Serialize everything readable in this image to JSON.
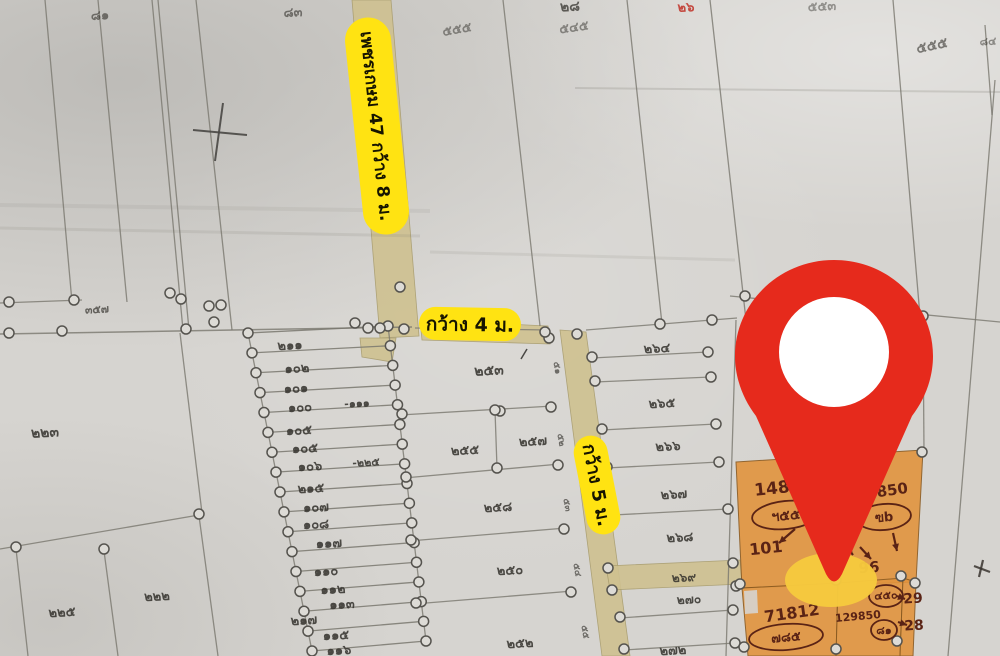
{
  "map": {
    "colors": {
      "paper": "#d6d4d0",
      "pencil": "#7a786f",
      "ink": "#33312c",
      "road_fill": "#cfc190",
      "label_bg": "#ffe312",
      "label_text": "#161400",
      "pin_red": "#e62a1c",
      "pin_shadow": "#f6c93e",
      "plot_orange": "#e2943e",
      "handwriting": "#5a2315",
      "red_note": "#c03026"
    },
    "road_labels": [
      {
        "text": "เพชรเกษม 47 กว้าง 8 ม.",
        "cx": 377,
        "cy": 126,
        "w": 218,
        "h": 46,
        "rotate": 84,
        "fs": 17
      },
      {
        "text": "กว้าง 4 ม.",
        "cx": 470,
        "cy": 324,
        "w": 102,
        "h": 33,
        "rotate": 1,
        "fs": 19
      },
      {
        "text": "กว้าง 5 ม.",
        "cx": 597,
        "cy": 485,
        "w": 100,
        "h": 34,
        "rotate": 79,
        "fs": 18
      }
    ],
    "pin": {
      "shadow": {
        "cx": 831,
        "cy": 580,
        "rx": 46,
        "ry": 27
      },
      "path": "M834 260 C779 260 735 303 735 356 C735 378 743 399 756 416 L826 574 Q834 589 842 574 L912 416 C925 399 933 378 933 356 C933 303 889 260 834 260 Z",
      "hole": {
        "cx": 834,
        "cy": 352,
        "r": 55
      }
    },
    "roads": [
      {
        "pts": "352,0 391,0 419,336 380,338"
      },
      {
        "pts": "360,338 396,338 392,362 362,357"
      },
      {
        "pts": "420,320 548,326 550,344 422,340"
      },
      {
        "pts": "560,330 586,332 630,656 602,656"
      },
      {
        "pts": "606,566 740,560 742,584 610,590"
      }
    ],
    "strips": {
      "count": 17,
      "left": [
        248,
        333,
        312,
        651
      ],
      "right": [
        388,
        326,
        426,
        641
      ]
    },
    "lines": [
      [
        45,
        0,
        72,
        302
      ],
      [
        98,
        0,
        127,
        302
      ],
      [
        152,
        0,
        183,
        330
      ],
      [
        158,
        0,
        189,
        330
      ],
      [
        196,
        0,
        232,
        330
      ],
      [
        503,
        0,
        540,
        326
      ],
      [
        627,
        0,
        662,
        324
      ],
      [
        710,
        0,
        746,
        320
      ],
      [
        893,
        0,
        920,
        316
      ],
      [
        985,
        25,
        992,
        115
      ],
      [
        995,
        80,
        948,
        656
      ],
      [
        0,
        303,
        82,
        300
      ],
      [
        0,
        334,
        412,
        327,
        1.5
      ],
      [
        415,
        328,
        548,
        330
      ],
      [
        586,
        330,
        737,
        318
      ],
      [
        730,
        296,
        1000,
        322
      ],
      [
        575,
        88,
        1000,
        92,
        2,
        0.22
      ],
      [
        0,
        228,
        420,
        236,
        3,
        0.14
      ],
      [
        430,
        252,
        735,
        260,
        3,
        0.12
      ],
      [
        0,
        205,
        430,
        211,
        4,
        0.1
      ],
      [
        180,
        333,
        202,
        513
      ],
      [
        0,
        549,
        199,
        515
      ],
      [
        16,
        549,
        28,
        656
      ],
      [
        104,
        551,
        118,
        656
      ],
      [
        199,
        516,
        218,
        656
      ],
      [
        193,
        130,
        247,
        135,
        2,
        0.9,
        "#4a4845"
      ],
      [
        223,
        103,
        215,
        161,
        2,
        0.9,
        "#4a4845"
      ],
      [
        400,
        415,
        553,
        406
      ],
      [
        495,
        410,
        497,
        468
      ],
      [
        404,
        478,
        560,
        464
      ],
      [
        409,
        541,
        566,
        528
      ],
      [
        414,
        604,
        573,
        591
      ],
      [
        592,
        358,
        708,
        352
      ],
      [
        595,
        382,
        711,
        377
      ],
      [
        602,
        430,
        716,
        424
      ],
      [
        607,
        468,
        719,
        462
      ],
      [
        613,
        515,
        728,
        509
      ],
      [
        620,
        618,
        733,
        610
      ],
      [
        624,
        650,
        735,
        643
      ],
      [
        736,
        320,
        726,
        656
      ],
      [
        923,
        318,
        924,
        452
      ],
      [
        388,
        326,
        426,
        641
      ],
      [
        248,
        333,
        312,
        651
      ],
      [
        521,
        359,
        527,
        349,
        1.5,
        0.9,
        "#3a3835"
      ],
      [
        974,
        566,
        990,
        572,
        2.2,
        0.85,
        "#3a3530"
      ],
      [
        983,
        560,
        979,
        577,
        2.2,
        0.85,
        "#3a3530"
      ]
    ],
    "circles": [
      [
        9,
        333
      ],
      [
        62,
        331
      ],
      [
        186,
        329
      ],
      [
        214,
        322
      ],
      [
        209,
        306
      ],
      [
        221,
        305
      ],
      [
        355,
        323
      ],
      [
        368,
        328
      ],
      [
        380,
        328
      ],
      [
        404,
        329
      ],
      [
        9,
        302
      ],
      [
        74,
        300
      ],
      [
        170,
        293
      ],
      [
        181,
        299
      ],
      [
        199,
        514
      ],
      [
        104,
        549
      ],
      [
        16,
        547
      ],
      [
        402,
        414
      ],
      [
        500,
        411
      ],
      [
        551,
        407
      ],
      [
        495,
        410
      ],
      [
        497,
        468
      ],
      [
        406,
        477
      ],
      [
        558,
        465
      ],
      [
        411,
        540
      ],
      [
        564,
        529
      ],
      [
        416,
        603
      ],
      [
        571,
        592
      ],
      [
        549,
        338
      ],
      [
        577,
        334
      ],
      [
        545,
        332
      ],
      [
        400,
        287
      ],
      [
        592,
        357
      ],
      [
        595,
        381
      ],
      [
        602,
        429
      ],
      [
        607,
        467
      ],
      [
        613,
        514
      ],
      [
        608,
        568
      ],
      [
        612,
        590
      ],
      [
        620,
        617
      ],
      [
        624,
        649
      ],
      [
        708,
        352
      ],
      [
        711,
        377
      ],
      [
        716,
        424
      ],
      [
        719,
        462
      ],
      [
        728,
        509
      ],
      [
        733,
        563
      ],
      [
        736,
        586
      ],
      [
        733,
        610
      ],
      [
        735,
        643
      ],
      [
        660,
        324
      ],
      [
        712,
        320
      ],
      [
        745,
        296
      ],
      [
        923,
        316
      ],
      [
        922,
        452
      ],
      [
        740,
        584
      ],
      [
        836,
        580
      ],
      [
        901,
        576
      ],
      [
        915,
        583
      ],
      [
        836,
        649
      ],
      [
        897,
        641
      ],
      [
        744,
        647
      ]
    ],
    "plot_labels": [
      {
        "t": "๒๑๑",
        "x": 290,
        "y": 346
      },
      {
        "t": "๑๐๒",
        "x": 297,
        "y": 369
      },
      {
        "t": "๑๐๑",
        "x": 296,
        "y": 389
      },
      {
        "t": "๑๐๐",
        "x": 300,
        "y": 408
      },
      {
        "t": "-๑๑๑",
        "x": 357,
        "y": 404,
        "s": 11
      },
      {
        "t": "๑๐๕",
        "x": 299,
        "y": 431
      },
      {
        "t": "๑๐๕",
        "x": 305,
        "y": 449
      },
      {
        "t": "๑๐๖",
        "x": 310,
        "y": 467
      },
      {
        "t": "-๒๒๕",
        "x": 366,
        "y": 463,
        "s": 11
      },
      {
        "t": "๒๑๕",
        "x": 311,
        "y": 489
      },
      {
        "t": "๑๐๗",
        "x": 316,
        "y": 508
      },
      {
        "t": "๑๐๘",
        "x": 316,
        "y": 525
      },
      {
        "t": "๑๑๗",
        "x": 329,
        "y": 544
      },
      {
        "t": "๑๑๐",
        "x": 326,
        "y": 572
      },
      {
        "t": "๑๑๒",
        "x": 333,
        "y": 590
      },
      {
        "t": "๑๑๓",
        "x": 342,
        "y": 605
      },
      {
        "t": "๒๑๗",
        "x": 304,
        "y": 621
      },
      {
        "t": "๑๑๕",
        "x": 336,
        "y": 636
      },
      {
        "t": "๑๑๖",
        "x": 339,
        "y": 651
      },
      {
        "t": "๒๒๓",
        "x": 45,
        "y": 433,
        "s": 14
      },
      {
        "t": "๒๒๕",
        "x": 62,
        "y": 613
      },
      {
        "t": "๒๒๒",
        "x": 157,
        "y": 597
      },
      {
        "t": "๓๕๗",
        "x": 97,
        "y": 310,
        "s": 11,
        "o": 0.7
      },
      {
        "t": "๒๕๓",
        "x": 489,
        "y": 371,
        "s": 14
      },
      {
        "t": "๒๕๕",
        "x": 465,
        "y": 451
      },
      {
        "t": "๒๕๗",
        "x": 533,
        "y": 442
      },
      {
        "t": "๒๕๘",
        "x": 498,
        "y": 508
      },
      {
        "t": "๒๕๐",
        "x": 510,
        "y": 571
      },
      {
        "t": "๒๕๒",
        "x": 520,
        "y": 644
      },
      {
        "t": "๒๖๔",
        "x": 657,
        "y": 349
      },
      {
        "t": "๒๖๕",
        "x": 662,
        "y": 404
      },
      {
        "t": "๒๖๖",
        "x": 668,
        "y": 447
      },
      {
        "t": "๒๖๗",
        "x": 674,
        "y": 495
      },
      {
        "t": "๒๖๘",
        "x": 680,
        "y": 538
      },
      {
        "t": "๒๖๙",
        "x": 684,
        "y": 578,
        "s": 12
      },
      {
        "t": "๒๗๐",
        "x": 689,
        "y": 600,
        "s": 12
      },
      {
        "t": "๒๗๒",
        "x": 673,
        "y": 651
      },
      {
        "t": "๘๑",
        "x": 100,
        "y": 16,
        "o": 0.6
      },
      {
        "t": "๘๓",
        "x": 293,
        "y": 13,
        "o": 0.6
      },
      {
        "t": "๕๕๕",
        "x": 457,
        "y": 30,
        "o": 0.5,
        "r": -10
      },
      {
        "t": "๒๘",
        "x": 570,
        "y": 7,
        "s": 14,
        "o": 0.75
      },
      {
        "t": "๕๔๕",
        "x": 574,
        "y": 28,
        "o": 0.5,
        "r": -8
      },
      {
        "t": "๒๖",
        "x": 686,
        "y": 8,
        "s": 13,
        "o": 0.85,
        "c": "#c03026"
      },
      {
        "t": "๕๕๓",
        "x": 822,
        "y": 7,
        "o": 0.45
      },
      {
        "t": "๕๕๕",
        "x": 932,
        "y": 46,
        "s": 14,
        "o": 0.6,
        "r": -12
      },
      {
        "t": "๘๔",
        "x": 988,
        "y": 42,
        "s": 11,
        "o": 0.5
      },
      {
        "t": "๕๑",
        "x": 557,
        "y": 368,
        "s": 9,
        "r": 80,
        "o": 0.65
      },
      {
        "t": "๕๒",
        "x": 561,
        "y": 440,
        "s": 9,
        "r": 80,
        "o": 0.65
      },
      {
        "t": "๕๓",
        "x": 567,
        "y": 505,
        "s": 9,
        "r": 80,
        "o": 0.65
      },
      {
        "t": "๕๔",
        "x": 577,
        "y": 570,
        "s": 9,
        "r": 80,
        "o": 0.65
      },
      {
        "t": "๕๕",
        "x": 585,
        "y": 632,
        "s": 9,
        "r": 80,
        "o": 0.65
      }
    ],
    "highlighted_plots": [
      {
        "pts": "736,462 923,450 916,582 742,588"
      },
      {
        "pts": "742,588 838,583 836,656 748,656"
      },
      {
        "pts": "838,583 903,578 900,656 836,656"
      },
      {
        "pts": "903,578 916,582 913,656 900,656"
      }
    ],
    "annotations": [
      {
        "t": "148",
        "x": 772,
        "y": 489,
        "s": 17,
        "r": -6
      },
      {
        "t": "ฯ๕๕",
        "x": 786,
        "y": 516,
        "s": 14,
        "r": -6
      },
      {
        "t": "101",
        "x": 766,
        "y": 549,
        "s": 16,
        "r": -6
      },
      {
        "t": "14850",
        "x": 882,
        "y": 492,
        "s": 15,
        "r": -8
      },
      {
        "t": "ฃb",
        "x": 884,
        "y": 518,
        "s": 13,
        "r": -5
      },
      {
        "t": "96",
        "x": 869,
        "y": 568,
        "s": 15,
        "r": -4
      },
      {
        "t": "71812",
        "x": 792,
        "y": 614,
        "s": 16,
        "r": -8
      },
      {
        "t": "๗๘๕",
        "x": 786,
        "y": 638,
        "s": 13,
        "r": -5
      },
      {
        "t": "๔๕๐",
        "x": 886,
        "y": 596,
        "s": 11,
        "r": -3
      },
      {
        "t": "29",
        "x": 913,
        "y": 599,
        "s": 14,
        "r": -3
      },
      {
        "t": "129850",
        "x": 858,
        "y": 617,
        "s": 11,
        "r": -5
      },
      {
        "t": "๘๑",
        "x": 884,
        "y": 631,
        "s": 11,
        "r": 0
      },
      {
        "t": "28",
        "x": 914,
        "y": 626,
        "s": 14,
        "r": -3
      }
    ],
    "ann_ellipses": [
      [
        786,
        515,
        34,
        14,
        -6
      ],
      [
        884,
        517,
        27,
        13,
        -5
      ],
      [
        786,
        637,
        37,
        13,
        -4
      ],
      [
        886,
        596,
        17,
        11,
        0
      ],
      [
        884,
        630,
        13,
        10,
        0
      ]
    ],
    "ann_arrows": [
      [
        795,
        529,
        779,
        543
      ],
      [
        893,
        533,
        897,
        551
      ],
      [
        842,
        541,
        853,
        555
      ],
      [
        860,
        547,
        871,
        559
      ],
      [
        897,
        596,
        905,
        599
      ],
      [
        898,
        622,
        907,
        625
      ]
    ]
  }
}
